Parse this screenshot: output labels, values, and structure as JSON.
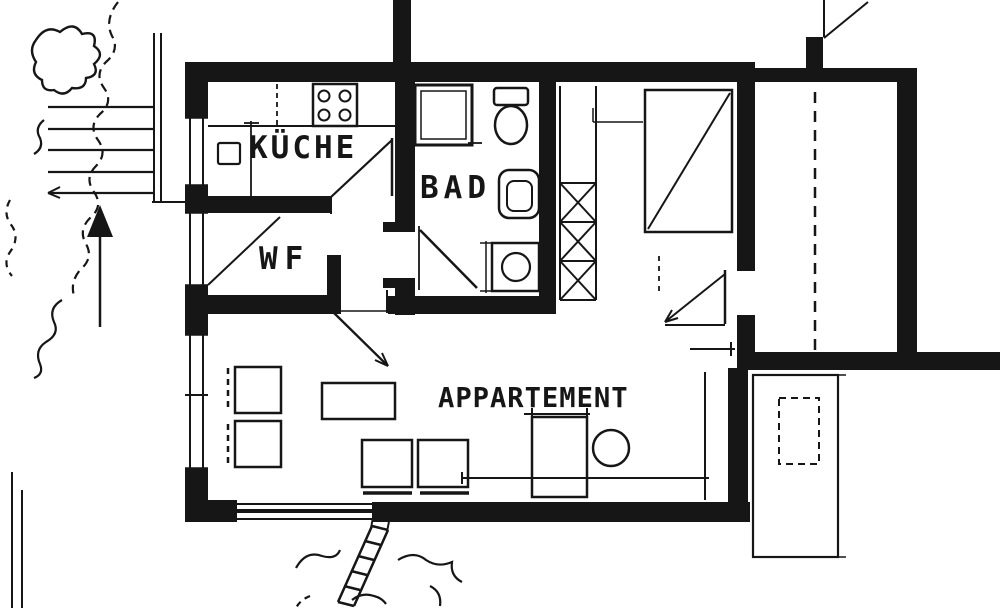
{
  "document": {
    "kind": "architectural-floor-plan",
    "style": "black-ink scanned blueprint, single apartment"
  },
  "plan": {
    "rooms": {
      "kitchen": {
        "label": "KÜCHE"
      },
      "bath": {
        "label": "BAD"
      },
      "vestibule": {
        "label": "WF"
      },
      "apartment": {
        "label": "APPARTEMENT"
      }
    },
    "symbols": {
      "north_arrow": "north-arrow-icon",
      "stove": "stove-icon",
      "kitchen_sink": "kitchen-sink-icon",
      "shower": "shower-icon",
      "toilet": "toilet-icon",
      "washbasin": "washbasin-icon",
      "washing_machine": "washing-machine-icon",
      "wardrobe": "wardrobe-icon",
      "shaft_hatch": "hatched-shaft",
      "exterior_stairs": "steps-lines",
      "garden_ladder": "ladder-icon",
      "balcony": "balcony-outline",
      "vegetation": "vegetation-sketch"
    },
    "colors": {
      "ink": "#161616",
      "paper": "#ffffff"
    }
  }
}
